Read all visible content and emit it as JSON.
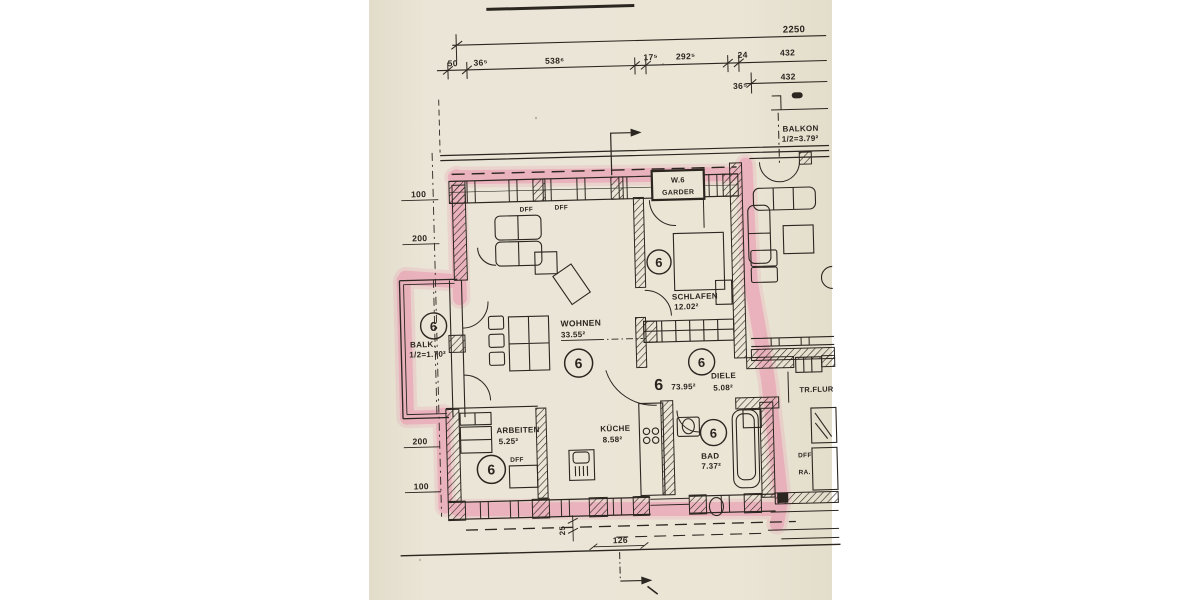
{
  "scan": {
    "unit_number": "6",
    "unit_total_area": "73.95²",
    "top_dimensions": {
      "overall": "2250",
      "seg1": "50",
      "seg2": "36⁵",
      "seg3": "538⁶",
      "seg4": "17⁵",
      "seg5": "292⁵",
      "seg6": "24",
      "seg7": "432",
      "row2_a": "36⁵",
      "row2_b": "432"
    },
    "left_dimensions": {
      "d1": "100",
      "d2": "200",
      "d3": "200",
      "d4": "100"
    },
    "bottom_dimensions": {
      "width": "126",
      "offset": "25"
    },
    "rooms": {
      "wohnen": {
        "name": "WOHNEN",
        "area": "33.55²"
      },
      "schlafen": {
        "name": "SCHLAFEN",
        "area": "12.02²"
      },
      "diele": {
        "name": "DIELE",
        "area": "5.08²"
      },
      "arbeiten": {
        "name": "ARBEITEN",
        "area": "5.25²"
      },
      "kueche": {
        "name": "KÜCHE",
        "area": "8.58²"
      },
      "bad": {
        "name": "BAD",
        "area": "7.37²"
      },
      "balk_left": {
        "name": "BALK.",
        "area": "1/2=1.70²"
      },
      "balkon_right": {
        "name": "BALKON",
        "area": "1/2=3.79²"
      }
    },
    "labels": {
      "unit_box_line1": "W.6",
      "unit_box_line2": "GARDER",
      "dff": "DFF",
      "ra": "RA.",
      "stair_hall": "TR.FLUR"
    },
    "colors": {
      "paper": "#e9e4d4",
      "ink": "#2b2620",
      "highlighter": "#ea83a6"
    }
  }
}
